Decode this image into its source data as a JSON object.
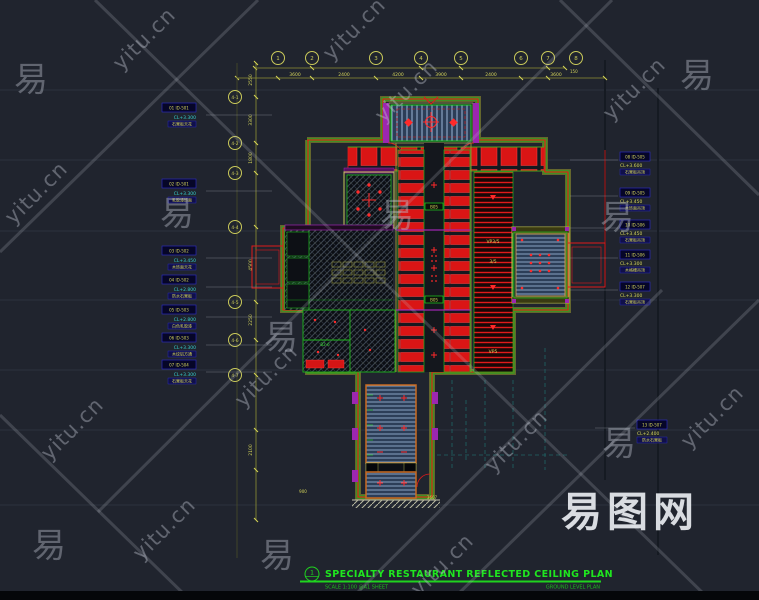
{
  "watermark": {
    "char": "易",
    "url": "yitu.cn",
    "site": "易图网"
  },
  "title_block": {
    "number": "1",
    "title": "SPECIALTY RESTAURANT REFLECTED CEILING PLAN",
    "sub_left": "SCALE 1:100 @A1 SHEET",
    "sub_right": "GROUND LEVEL PLAN"
  },
  "grid": {
    "top_bubbles": [
      "1",
      "2",
      "3",
      "4",
      "5",
      "6",
      "7",
      "8"
    ],
    "left_bubbles": [
      "4-1",
      "4-2",
      "4-3",
      "4-4",
      "4-5",
      "4-6",
      "4-7"
    ]
  },
  "dimensions": {
    "top": [
      "3600",
      "2400",
      "4200",
      "3900",
      "2400",
      "3600"
    ],
    "left": [
      "2550",
      "3300",
      "1800",
      "4500",
      "2250",
      "2100"
    ],
    "right_small": "150",
    "stair_width": "3607",
    "stair_left": "900"
  },
  "callouts_left": [
    {
      "tag": "01 ID-501",
      "note1": "CL+3.300",
      "note2": "石膏板天花"
    },
    {
      "tag": "02 ID-501",
      "note1": "CL+3.300",
      "note2": "乳胶漆饰面"
    },
    {
      "tag": "03 ID-502",
      "note1": "CL+3.450",
      "note2": "木饰面天花"
    },
    {
      "tag": "04 ID-502",
      "note1": "CL+2.800",
      "note2": "防水石膏板"
    },
    {
      "tag": "05 ID-503",
      "note1": "CL+2.800",
      "note2": "白色乳胶漆"
    },
    {
      "tag": "06 ID-503",
      "note1": "CL+3.300",
      "note2": "木纹铝方通"
    },
    {
      "tag": "07 ID-504",
      "note1": "CL+3.300",
      "note2": "石膏板天花"
    }
  ],
  "callouts_right": [
    {
      "tag": "08 ID-505",
      "note1": "CL+3.600",
      "note2": "石膏板吊顶"
    },
    {
      "tag": "09 ID-505",
      "note1": "CL+3.450",
      "note2": "木饰面吊顶"
    },
    {
      "tag": "10 ID-506",
      "note1": "CL+3.450",
      "note2": "石膏板吊顶"
    },
    {
      "tag": "11 ID-506",
      "note1": "CL+3.300",
      "note2": "木格栅吊顶"
    },
    {
      "tag": "12 ID-507",
      "note1": "CL+3.300",
      "note2": "石膏板吊顶"
    },
    {
      "tag": "13 ID-507",
      "note1": "CL+2.400",
      "note2": "防水石膏板"
    }
  ],
  "plan_labels": {
    "vp1": "VP3/5",
    "vp2": "3/5",
    "vp3": "VP5",
    "aisle_tag_a": "B05",
    "aisle_tag_b": "B05",
    "room_tag": "B2-6"
  },
  "colors": {
    "red": "#e01a1a",
    "green": "#1fd41f",
    "yellow": "#d6d65a",
    "cyan": "#35cfcf",
    "magenta": "#9c27b0",
    "slat_blue": "#2c3e58",
    "background": "#20242e"
  }
}
